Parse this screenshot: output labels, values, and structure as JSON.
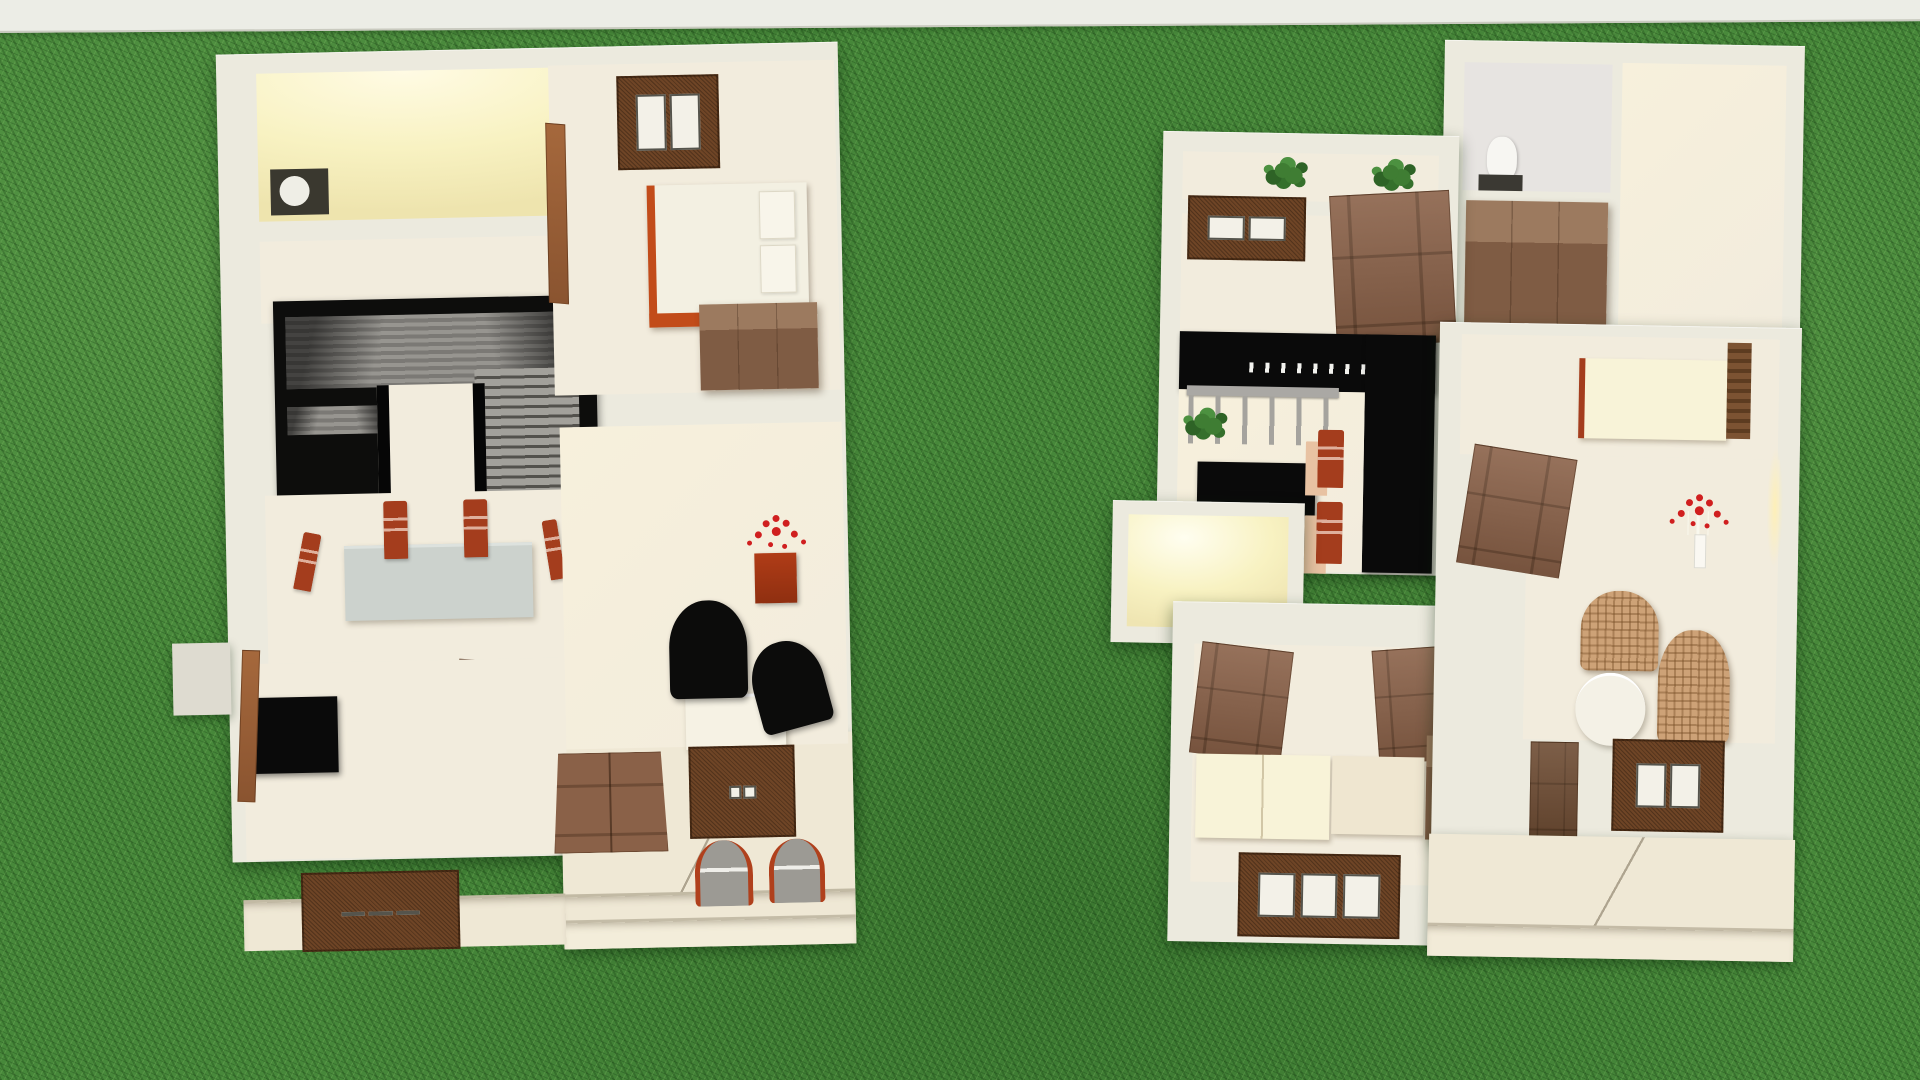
{
  "scene": {
    "type": "3d-dollhouse-floorplan-render",
    "environment": "grass-lawn",
    "top_edge": "pavement-strip",
    "floorplan_count": 2
  },
  "colors": {
    "grass": "#47883a",
    "grass_dark": "#2c6527",
    "grass_light": "#79b55f",
    "pavement": "#ecede6",
    "wall": "#eceade",
    "wall_shadow": "#dedbd0",
    "floor": "#f2ecdd",
    "floor_warm": "#f7f0dc",
    "porch": "#efe8d5",
    "lit": "#f8f2c2",
    "glow": "#fffbe4",
    "wood": "#8a6148",
    "wood_dark": "#6e4c33",
    "frame": "#6f4526",
    "bed_white": "#f3f0e2",
    "bed_base": "#c24c1a",
    "chair_red": "#a43d1d",
    "table_gray": "#ccd2cd",
    "black": "#0a0a0a",
    "stair_gray": "#908e8a",
    "plant": "#3f7d33",
    "flower": "#d01f1f",
    "wicker": "#cda277",
    "seat_gray": "#9c9c9c",
    "seat_tan": "#e8c2a2",
    "bath_floor": "#e7e4e1",
    "cream": "#f8f3d8"
  },
  "floorplans": [
    {
      "id": "left-floorplan",
      "rooms": [
        {
          "name": "kitchen",
          "lighting": "lit",
          "furniture": [
            "stove"
          ]
        },
        {
          "name": "hallway",
          "furniture": []
        },
        {
          "name": "stair-hall",
          "furniture": [
            "u-shaped-staircase"
          ]
        },
        {
          "name": "dining-room",
          "furniture": [
            "dining-table",
            "dining-chair",
            "dining-chair",
            "dining-chair",
            "dining-chair",
            "open-door"
          ]
        },
        {
          "name": "living-room",
          "furniture": [
            "tv-cabinet",
            "leaning-door",
            "triple-window"
          ]
        },
        {
          "name": "bedroom",
          "furniture": [
            "double-window",
            "double-bed",
            "pillow",
            "pillow",
            "wardrobe",
            "open-door"
          ]
        },
        {
          "name": "sitting-room",
          "furniture": [
            "flower-stand",
            "black-armchair",
            "black-armchair",
            "white-desk"
          ]
        },
        {
          "name": "entrance-porch",
          "furniture": [
            "double-entry-door",
            "double-window",
            "porch-chair",
            "porch-chair",
            "steps"
          ]
        }
      ]
    },
    {
      "id": "right-floorplan",
      "rooms": [
        {
          "name": "bathroom",
          "furniture": [
            "toilet",
            "bath-mat"
          ]
        },
        {
          "name": "upper-hallway",
          "furniture": [
            "large-wardrobe"
          ]
        },
        {
          "name": "balcony-planter",
          "furniture": [
            "plant",
            "plant"
          ]
        },
        {
          "name": "bedroom-north",
          "furniture": [
            "double-window",
            "open-door"
          ]
        },
        {
          "name": "kitchen-bar",
          "furniture": [
            "black-counter-l",
            "bar-railing",
            "bottle-row",
            "potted-plant",
            "black-table",
            "red-chair",
            "red-chair"
          ]
        },
        {
          "name": "utility-room",
          "lighting": "lit",
          "furniture": []
        },
        {
          "name": "middle-room",
          "furniture": [
            "cream-bed",
            "ladder-shelf"
          ]
        },
        {
          "name": "living-room",
          "furniture": [
            "open-door",
            "flower-bouquet",
            "wicker-armchair",
            "wicker-sofa",
            "coffee-table",
            "standing-door",
            "double-window"
          ]
        },
        {
          "name": "bedroom-south",
          "furniture": [
            "open-door",
            "open-door",
            "mattress",
            "mattress",
            "wardrobe",
            "triple-window"
          ]
        },
        {
          "name": "terrace",
          "furniture": [
            "steps"
          ]
        }
      ]
    }
  ]
}
